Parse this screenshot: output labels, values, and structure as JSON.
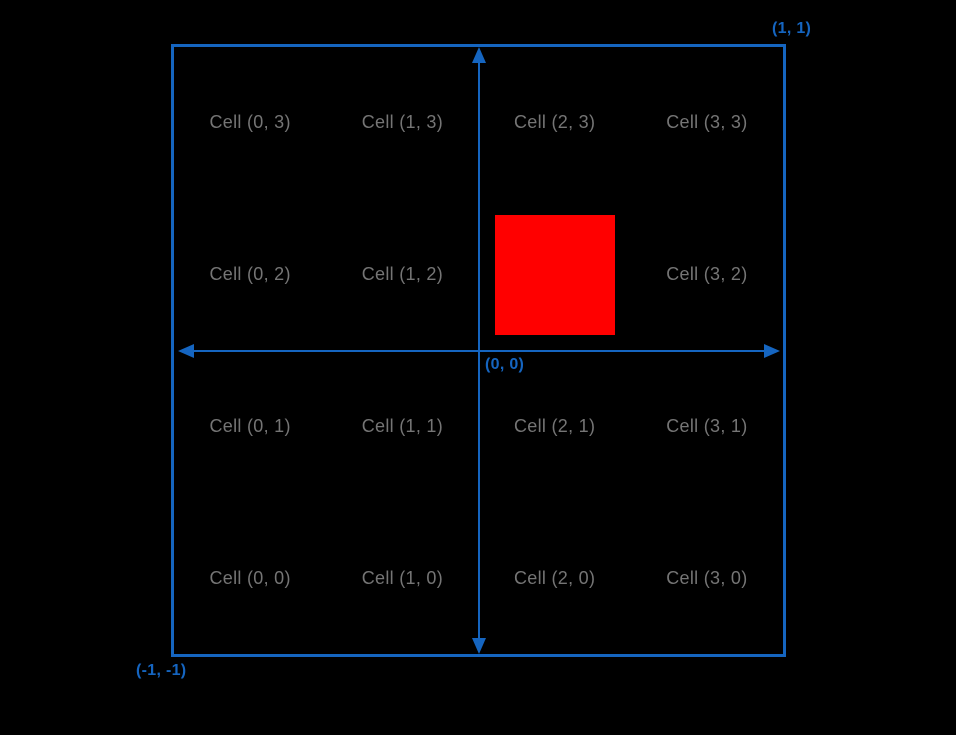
{
  "canvas": {
    "background_color": "#000000"
  },
  "board": {
    "border_color": "#1565C0",
    "corner_labels": {
      "top_right": "(1, 1)",
      "origin": "(0, 0)",
      "bottom_left": "(-1, -1)"
    },
    "axes": {
      "color": "#1565C0",
      "x_axis": "horizontal double-headed arrow through origin",
      "y_axis": "vertical double-headed arrow through origin"
    },
    "grid": {
      "rows": 4,
      "cols": 4,
      "label_color": "#757575",
      "highlight_color": "#FF0000",
      "cells": [
        {
          "label": "Cell (0, 3)"
        },
        {
          "label": "Cell (1, 3)"
        },
        {
          "label": "Cell (2, 3)"
        },
        {
          "label": "Cell (3, 3)"
        },
        {
          "label": "Cell (0, 2)"
        },
        {
          "label": "Cell (1, 2)"
        },
        {
          "label": "",
          "highlighted": true
        },
        {
          "label": "Cell (3, 2)"
        },
        {
          "label": "Cell (0, 1)"
        },
        {
          "label": "Cell (1, 1)"
        },
        {
          "label": "Cell (2, 1)"
        },
        {
          "label": "Cell (3, 1)"
        },
        {
          "label": "Cell (0, 0)"
        },
        {
          "label": "Cell (1, 0)"
        },
        {
          "label": "Cell (2, 0)"
        },
        {
          "label": "Cell (3, 0)"
        }
      ]
    }
  }
}
